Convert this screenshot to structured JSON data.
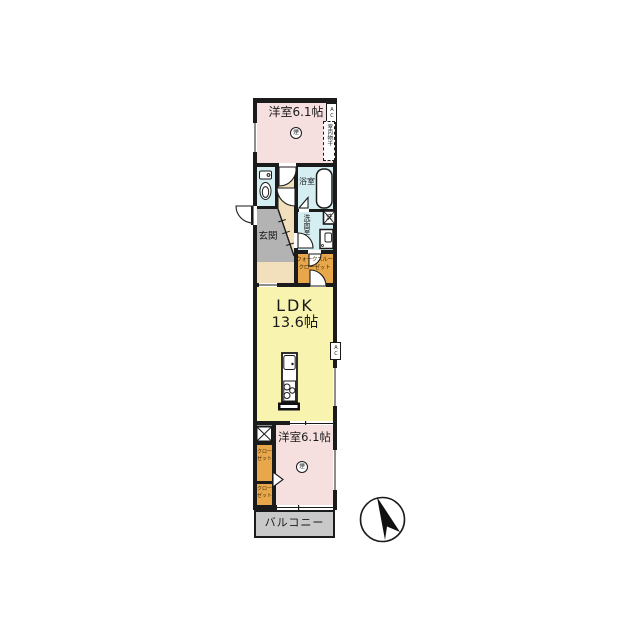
{
  "plan": {
    "rooms": {
      "bedroom_top": {
        "label": "洋室6.1帖"
      },
      "bath": {
        "label": "浴室"
      },
      "washroom": {
        "label": "洗面室"
      },
      "genkan": {
        "label": "玄関"
      },
      "walkthrough_closet": {
        "line1": "ウォークスルー",
        "line2": "クローゼット"
      },
      "ldk": {
        "name": "LDK",
        "size": "13.6帖"
      },
      "closet_upper": {
        "line1": "クロー",
        "line2": "ゼット"
      },
      "closet_lower": {
        "line1": "クロー",
        "line2": "ゼット"
      },
      "bedroom_bottom": {
        "label": "洋室6.1帖"
      },
      "balcony": {
        "label": "バルコニー"
      }
    },
    "symbols": {
      "ac_top": {
        "label": "AC"
      },
      "ac_ldk": {
        "label": "AC"
      },
      "indoor_drying": {
        "label": "室内物干"
      },
      "washer": {
        "label": "洗"
      },
      "smoke_top": {
        "label": "煙"
      },
      "smoke_bottom": {
        "label": "煙"
      }
    },
    "colors": {
      "wall": "#1b1b1b",
      "bedroom": "#f6dfdf",
      "ldk": "#f8f3ae",
      "wet": "#d4eef2",
      "hall": "#f2e0bd",
      "genkan": "#b3b3b3",
      "closet": "#e8a74b",
      "balcony": "#c9c9c9"
    }
  }
}
